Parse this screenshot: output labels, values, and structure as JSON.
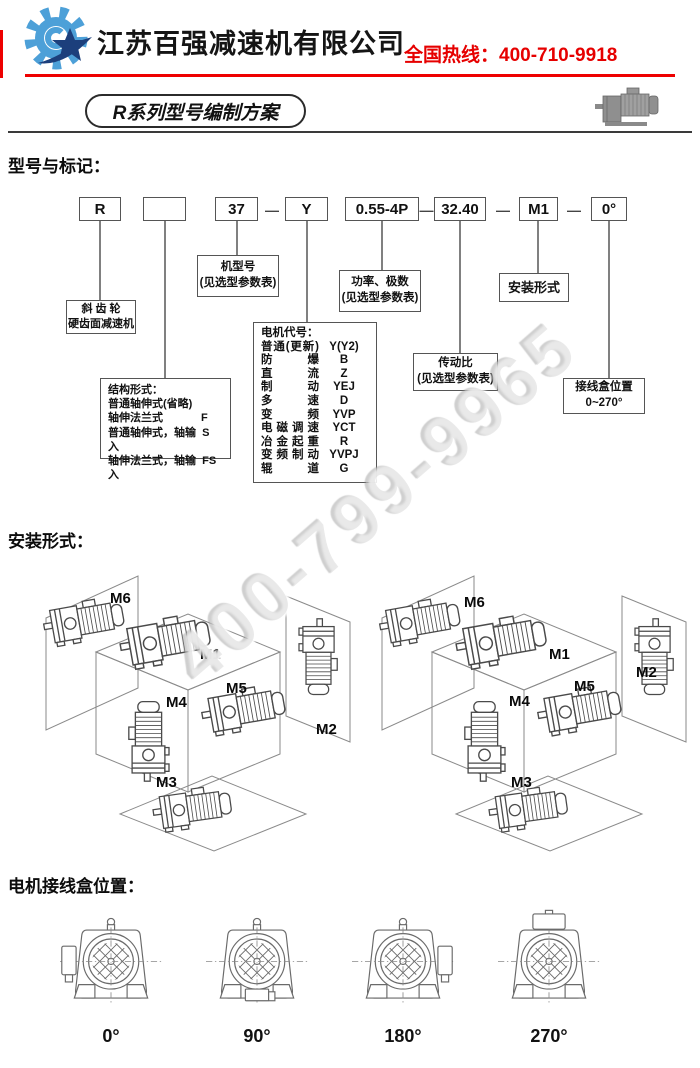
{
  "header": {
    "company_name": "江苏百强减速机有限公司",
    "hotline": "全国热线：400-710-9918",
    "accent_red": "#e60000",
    "logo_gear_color": "#4da0d8",
    "logo_star_color": "#1c3f7c"
  },
  "title_badge": "R系列型号编制方案",
  "watermark": "400-799-9965",
  "model_section": {
    "heading": "型号与标记：",
    "code": [
      "R",
      "",
      "37",
      "Y",
      "0.55-4P",
      "32.40",
      "M1",
      "0°"
    ],
    "dash": "—",
    "ann": {
      "series": [
        "斜 齿 轮",
        "硬齿面减速机"
      ],
      "frame": [
        "机型号",
        "(见选型参数表)"
      ],
      "power": [
        "功率、极数",
        "(见选型参数表)"
      ],
      "mounting": [
        "安装形式"
      ],
      "ratio": [
        "传动比",
        "(见选型参数表)"
      ],
      "terminal": [
        "接线盒位置",
        "0~270°"
      ],
      "structure": {
        "title": "结构形式：",
        "rows": [
          {
            "label": "普通轴伸式(省略)",
            "code": ""
          },
          {
            "label": "轴伸法兰式",
            "code": "F"
          },
          {
            "label": "普通轴伸式，轴输入",
            "code": "S"
          },
          {
            "label": "轴伸法兰式，轴输入",
            "code": "FS"
          }
        ]
      },
      "motor": {
        "title": "电机代号：",
        "rows": [
          {
            "label": "普通(更新)",
            "code": "Y(Y2)"
          },
          {
            "label": "防爆",
            "code": "B"
          },
          {
            "label": "直流",
            "code": "Z"
          },
          {
            "label": "制动",
            "code": "YEJ"
          },
          {
            "label": "多速",
            "code": "D"
          },
          {
            "label": "变频",
            "code": "YVP"
          },
          {
            "label": "电磁调速",
            "code": "YCT"
          },
          {
            "label": "冶金起重",
            "code": "R"
          },
          {
            "label": "变频制动",
            "code": "YVPJ"
          },
          {
            "label": "辊道",
            "code": "G"
          }
        ]
      }
    }
  },
  "mounting_section": {
    "heading": "安装形式：",
    "labels": {
      "m1": "M1",
      "m2": "M2",
      "m3": "M3",
      "m4": "M4",
      "m5": "M5",
      "m6": "M6"
    }
  },
  "terminal_section": {
    "heading": "电机接线盒位置：",
    "angles": [
      "0°",
      "90°",
      "180°",
      "270°"
    ]
  }
}
